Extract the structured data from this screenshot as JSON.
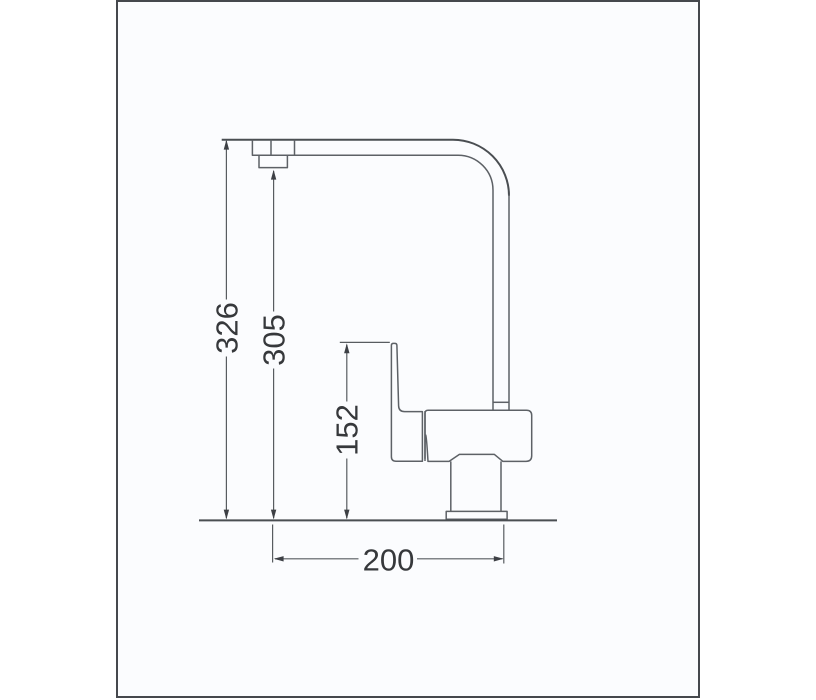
{
  "drawing": {
    "subject": "kitchen-faucet-side-view-dimension-drawing",
    "dimensions": {
      "overall_height": "326",
      "spout_outlet_height": "305",
      "handle_height": "152",
      "spout_reach": "200"
    },
    "colors": {
      "outline": "#5d6166",
      "strong_line": "#4a4e52",
      "dimension_line": "#585c60",
      "text": "#36383b",
      "frame_border": "#45484d",
      "canvas": "#fbfcfe",
      "page_background": "#ffffff"
    }
  }
}
